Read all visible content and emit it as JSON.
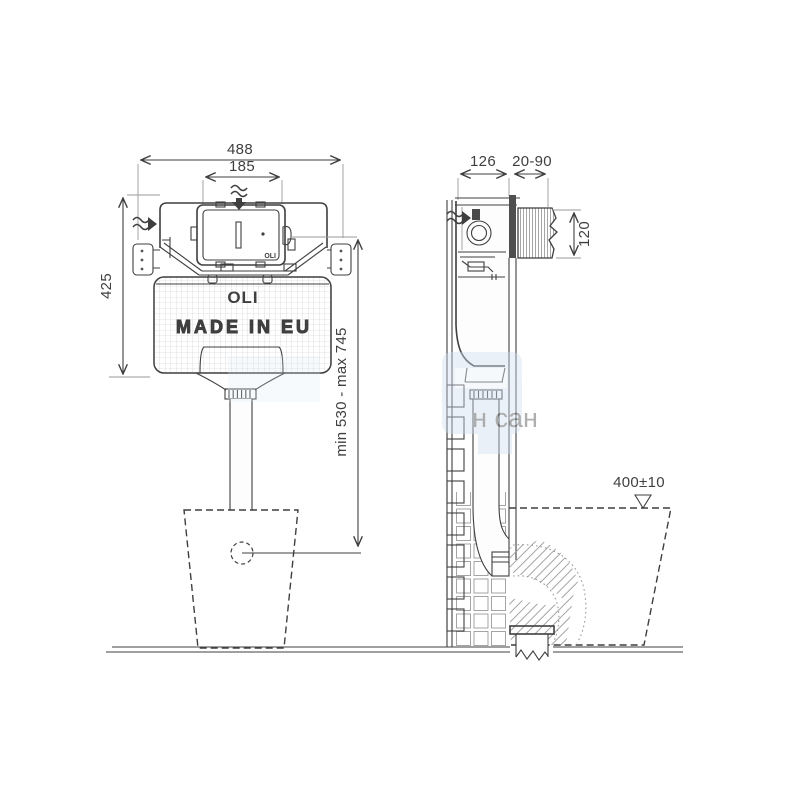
{
  "branding": {
    "tank_logo": "OLI",
    "tank_origin": "MADE IN EU",
    "panel_logo": "OLI"
  },
  "dimensions_front": {
    "overall_width": "488",
    "flush_plate_opening": "185",
    "cistern_height": "425",
    "flush_pipe_height_range": "min 530 - max 745"
  },
  "dimensions_side": {
    "cistern_depth": "126",
    "wall_finish_range": "20-90",
    "shaft_height": "120",
    "bowl_height": "400±10"
  },
  "watermark": {
    "text": "н сан"
  },
  "colors": {
    "line": "#3f3f3f",
    "light_line": "#9a9a9a",
    "watermark_blue": "#c6d9ec",
    "grid": "#c9c9c9"
  }
}
